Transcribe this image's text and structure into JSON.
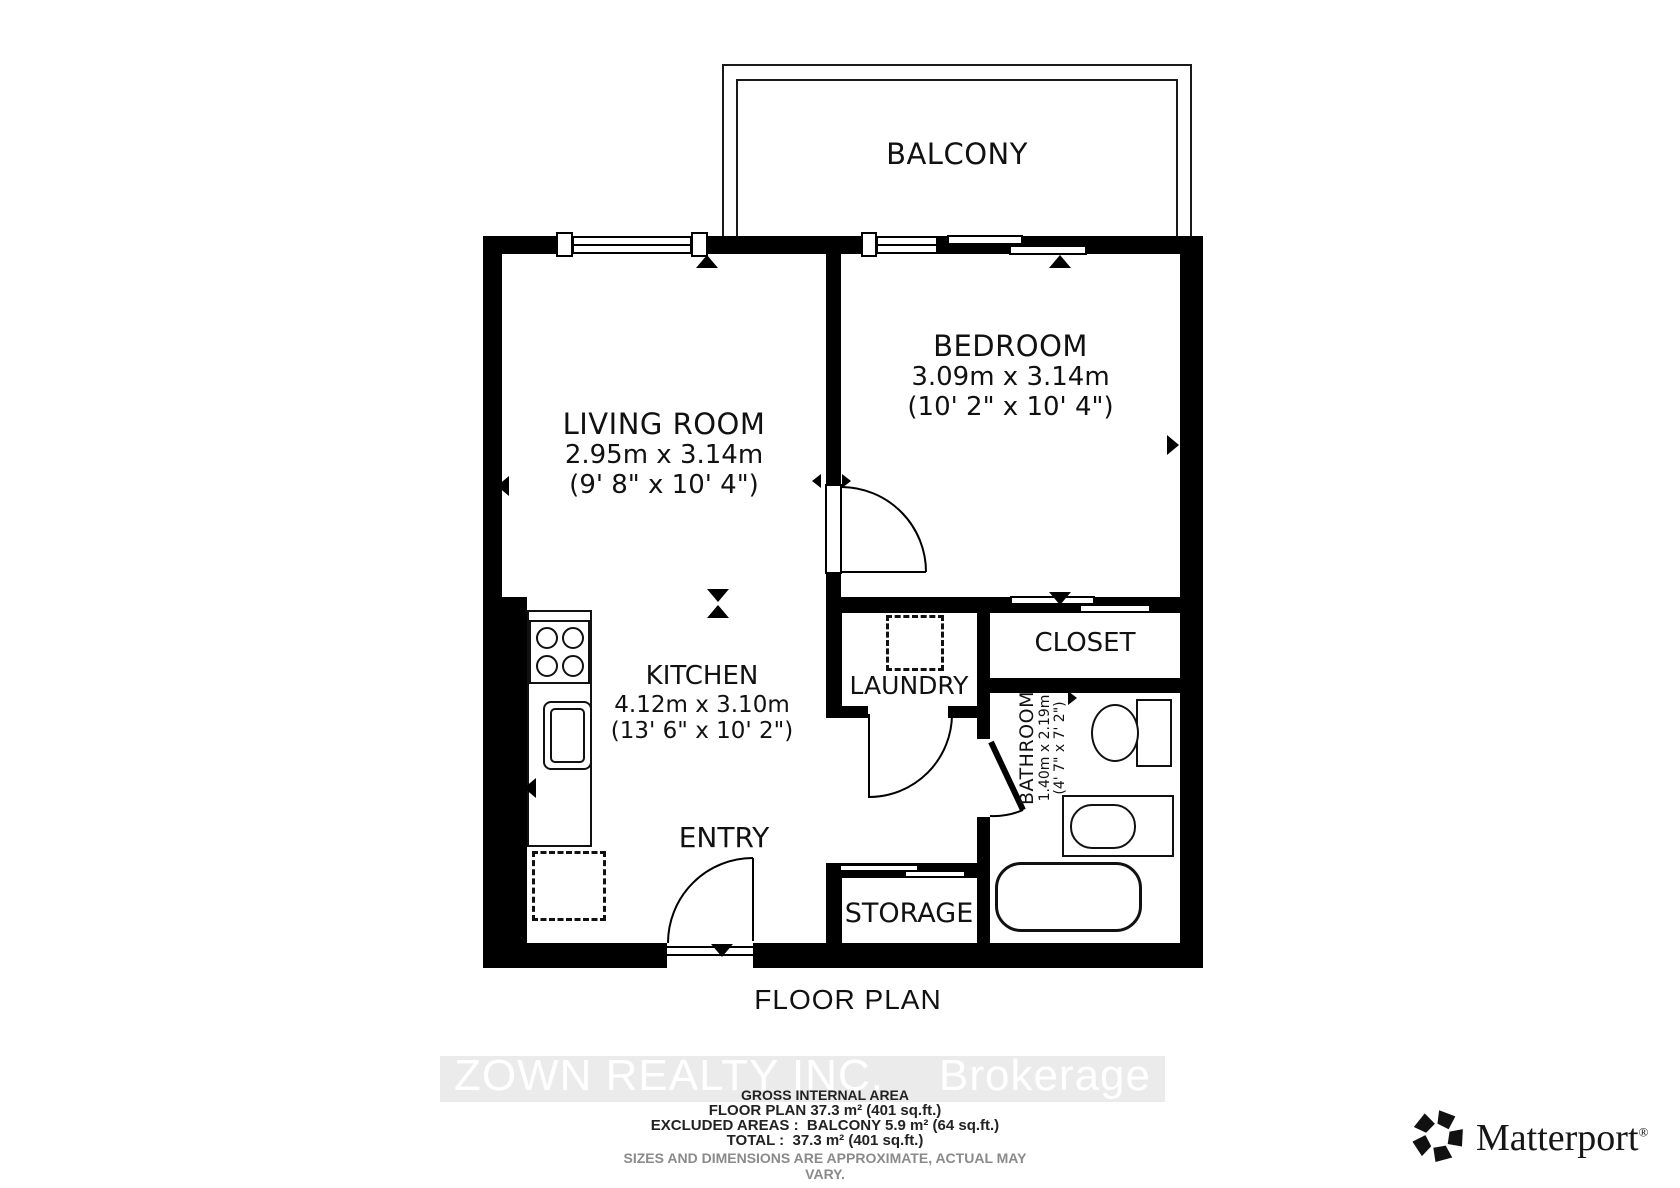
{
  "floorplan": {
    "balcony_label": "BALCONY",
    "title": "FLOOR PLAN",
    "rooms": {
      "living": {
        "name": "LIVING ROOM",
        "metric": "2.95m x 3.14m",
        "imperial": "(9' 8\" x 10' 4\")"
      },
      "bedroom": {
        "name": "BEDROOM",
        "metric": "3.09m x 3.14m",
        "imperial": "(10' 2\" x 10' 4\")"
      },
      "kitchen": {
        "name": "KITCHEN",
        "metric": "4.12m x 3.10m",
        "imperial": "(13' 6\" x 10' 2\")"
      },
      "bathroom": {
        "name": "BATHROOM",
        "metric": "1.40m x 2.19m",
        "imperial": "(4' 7\" x 7' 2\")"
      },
      "laundry": {
        "name": "LAUNDRY"
      },
      "closet": {
        "name": "CLOSET"
      },
      "entry": {
        "name": "ENTRY"
      },
      "storage": {
        "name": "STORAGE"
      }
    }
  },
  "watermark": {
    "line": "ZOWN REALTY INC.",
    "suffix": "Brokerage"
  },
  "summary": {
    "heading": "GROSS INTERNAL AREA",
    "floor_plan": "FLOOR PLAN 37.3 m² (401 sq.ft.)",
    "excluded": "EXCLUDED AREAS :  BALCONY 5.9 m² (64 sq.ft.)",
    "total": "TOTAL :  37.3 m² (401 sq.ft.)",
    "disclaimer": "SIZES AND DIMENSIONS ARE APPROXIMATE, ACTUAL MAY VARY."
  },
  "branding": {
    "logo_text": "Matterport",
    "registered_mark": "®",
    "icon": "matterport-pinwheel-icon"
  },
  "colors": {
    "wall": "#000000",
    "watermark_band": "#ebebeb",
    "watermark_text": "#ffffff",
    "disclaimer_text": "#8a8a8a"
  }
}
